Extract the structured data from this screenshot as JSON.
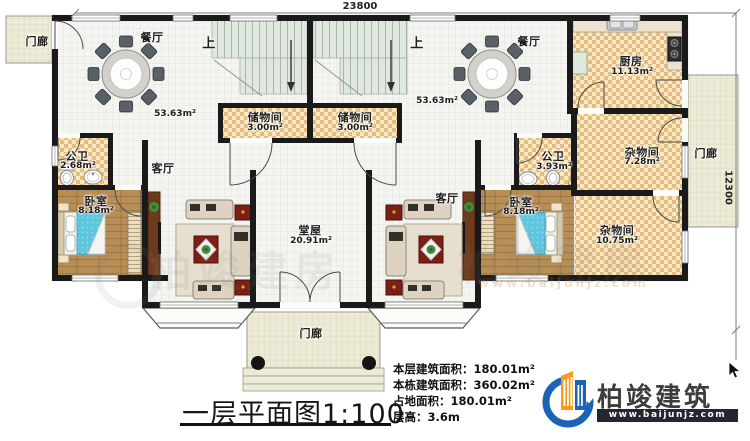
{
  "dimensions": {
    "width_mm": "23800",
    "height_mm": "12300"
  },
  "rooms": {
    "porch_tl": {
      "name": "门廊"
    },
    "dining_left": {
      "name": "餐厅",
      "area": "53.63m²"
    },
    "up_left": {
      "name": "上"
    },
    "storage_left": {
      "name": "储物间",
      "area": "3.00m²"
    },
    "storage_right": {
      "name": "储物间",
      "area": "3.00m²"
    },
    "up_right": {
      "name": "上"
    },
    "dining_right": {
      "name": "餐厅",
      "area": "53.63m²"
    },
    "kitchen": {
      "name": "厨房",
      "area": "11.13m²"
    },
    "bath_left": {
      "name": "公卫",
      "area": "2.68m²"
    },
    "living_left": {
      "name": "客厅"
    },
    "bedroom_left": {
      "name": "卧室",
      "area": "8.18m²"
    },
    "bath_right": {
      "name": "公卫",
      "area": "3.93m²"
    },
    "utility_small": {
      "name": "杂物间",
      "area": "7.28m²"
    },
    "porch_right": {
      "name": "门廊"
    },
    "living_right": {
      "name": "客厅"
    },
    "bedroom_right": {
      "name": "卧室",
      "area": "8.18m²"
    },
    "utility_large": {
      "name": "杂物间",
      "area": "10.75m²"
    },
    "hall": {
      "name": "堂屋",
      "area": "20.91m²"
    },
    "porch_bottom": {
      "name": "门廊"
    }
  },
  "footer": {
    "title": "一层平面图",
    "scale": "1:100",
    "stats": [
      "本层建筑面积：180.01m²",
      "本栋建筑面积：360.02m²",
      "占地面积：180.01m²",
      "层高：3.6m"
    ]
  },
  "brand": {
    "name": "柏竣建筑",
    "url": "www.baijunjz.com"
  },
  "watermark": {
    "text": "柏竣建房",
    "url": "www.baijunjz.com"
  },
  "colors": {
    "wall": "#1a1a1a",
    "checker_floor": "#e5bc7d",
    "wood_floor": "#b88e57",
    "bed_blue": "#5ec6dd",
    "table_red": "#7c1f15",
    "brand_blue": "#1a63b5",
    "brand_orange": "#f59b20"
  }
}
